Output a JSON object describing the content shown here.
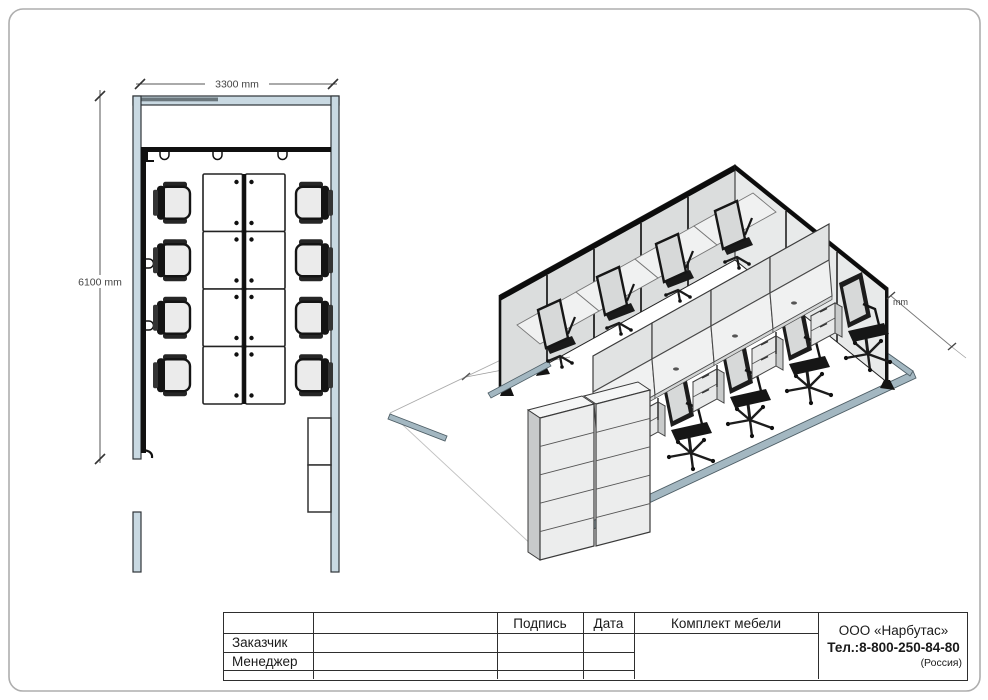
{
  "floor_plan": {
    "width_dim": "3300 mm",
    "height_dim": "6100 mm"
  },
  "iso_view": {
    "dim_label": "mm"
  },
  "title_block": {
    "row_labels": {
      "customer": "Заказчик",
      "manager": "Менеджер"
    },
    "columns": {
      "signature": "Подпись",
      "date": "Дата"
    },
    "project_title": "Комплект мебели",
    "company": {
      "name": "ООО «Нарбутас»",
      "phone": "Тел.:8-800-250-84-80",
      "country": "(Россия)"
    }
  },
  "colors": {
    "wall_2d": "#c9d9e2",
    "wall_dark_strip": "#6a767c",
    "partition_black": "#101010",
    "iso_panel": "#dbdddd",
    "iso_rail": "#a3b7c1",
    "chair_cushion": "#d7d9d9"
  }
}
